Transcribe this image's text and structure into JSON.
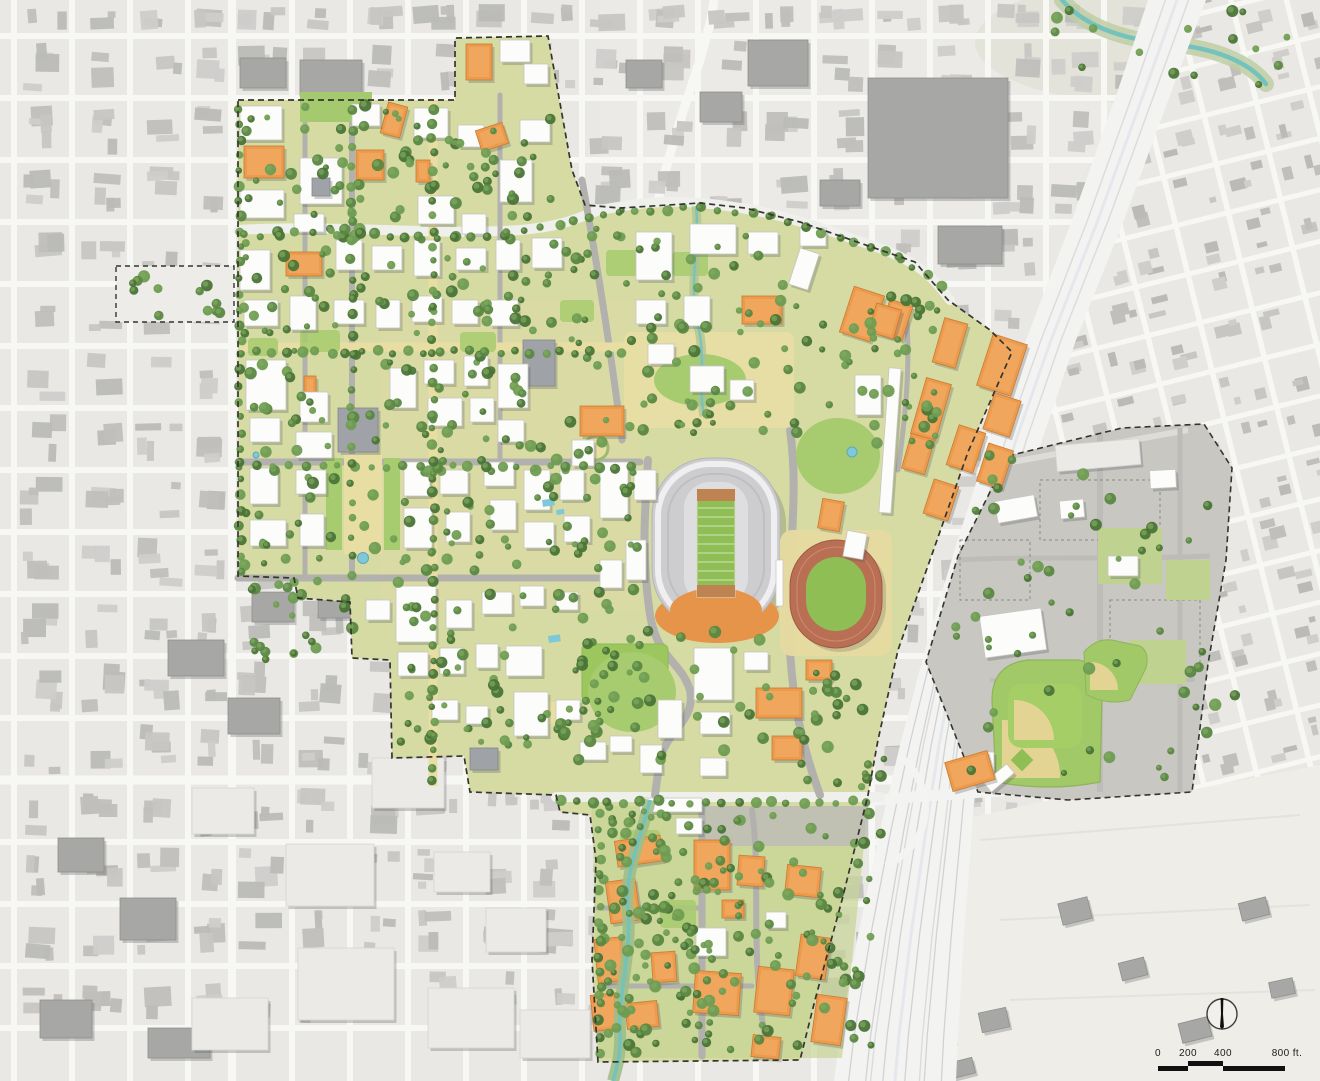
{
  "map": {
    "type": "campus-master-plan-illustrative-aerial",
    "scale_bar": {
      "ticks": [
        "0",
        "200",
        "400",
        "800 ft."
      ]
    },
    "compass": {
      "direction": "north"
    },
    "features": [
      "surrounding-city-fabric",
      "campus-core",
      "campus-boundary-dashed",
      "football-stadium",
      "running-track-stadium",
      "baseball-field",
      "softball-field",
      "recreation-lawn",
      "south-campus-district",
      "east-campus-parcel",
      "highway-rail-corridor",
      "creek",
      "tree-canopy"
    ],
    "palette": {
      "city_background": "#E9E8E4",
      "city_street": "#F7F7F4",
      "city_building": "#C7C6C3",
      "city_building_dark": "#A7A7A5",
      "bigbox_light": "#EBEAE6",
      "campus_ground": "#D5DBA3",
      "campus_lawn": "#A7CB6F",
      "campus_field": "#9CC75E",
      "campus_plaza_tan": "#E8DEA4",
      "campus_road": "#B2B1AD",
      "campus_street_white": "#EFEFEC",
      "tree_dark": "#4A7437",
      "tree_mid": "#5A8742",
      "tree_light": "#6E9C52",
      "building_white": "#FCFCFA",
      "building_orange": "#EC9B4C",
      "orange_shade": "#C97B35",
      "orange_ridge": "#F4B06B",
      "slate_roof": "#9FA2A6",
      "stadium_bowl": "#CDCDD0",
      "stadium_rim": "#EFEFF1",
      "field_green": "#8FBE55",
      "endzone_orange": "#BE8350",
      "stadium_plaza_orange": "#E59449",
      "track_surface": "#B96F53",
      "infield_tan": "#E3D493",
      "highway_surface": "#F3F3F1",
      "rail_line": "#D2D2D5",
      "creek_teal": "#74C2BC",
      "creek_bank": "#A9C291",
      "water_blue": "#7FC8D8",
      "open_land": "#EFEDE8",
      "boundary_dash": "#35352F",
      "scalebar_black": "#111111"
    }
  }
}
